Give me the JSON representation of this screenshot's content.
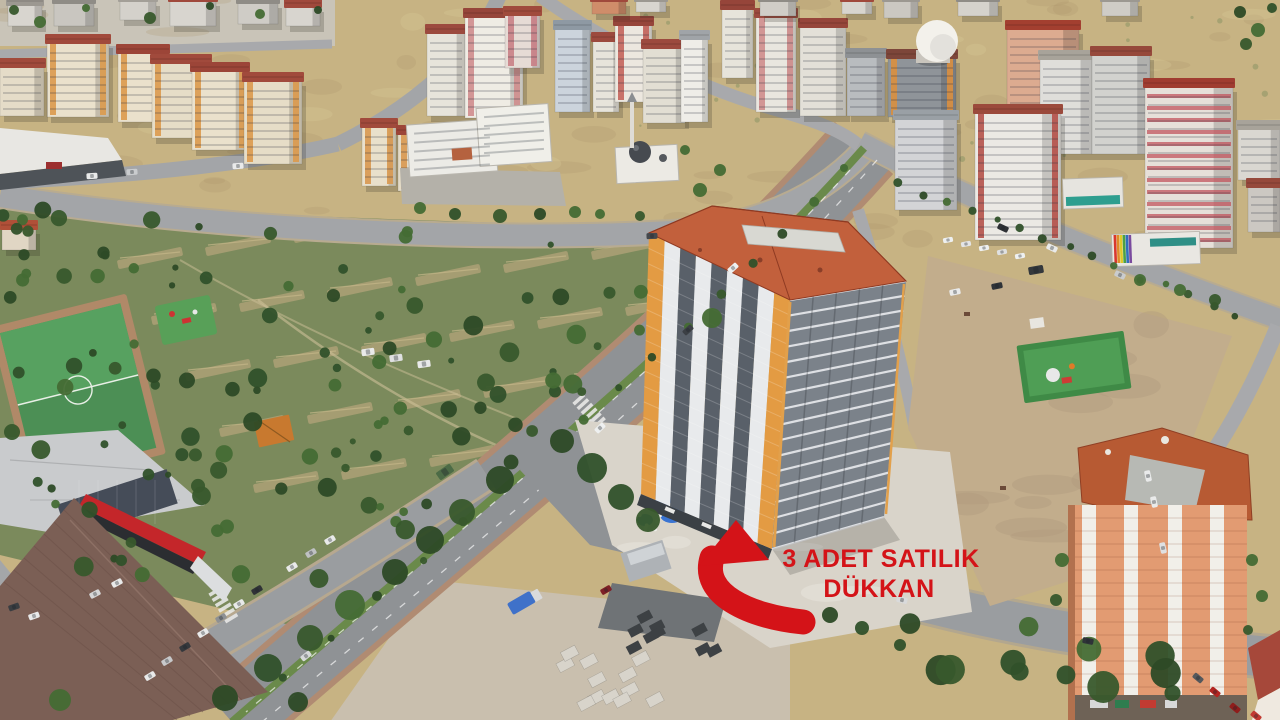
{
  "annotation": {
    "line1": "3 ADET SATILIK",
    "line2": "DÜKKAN",
    "color": "#d41318"
  }
}
